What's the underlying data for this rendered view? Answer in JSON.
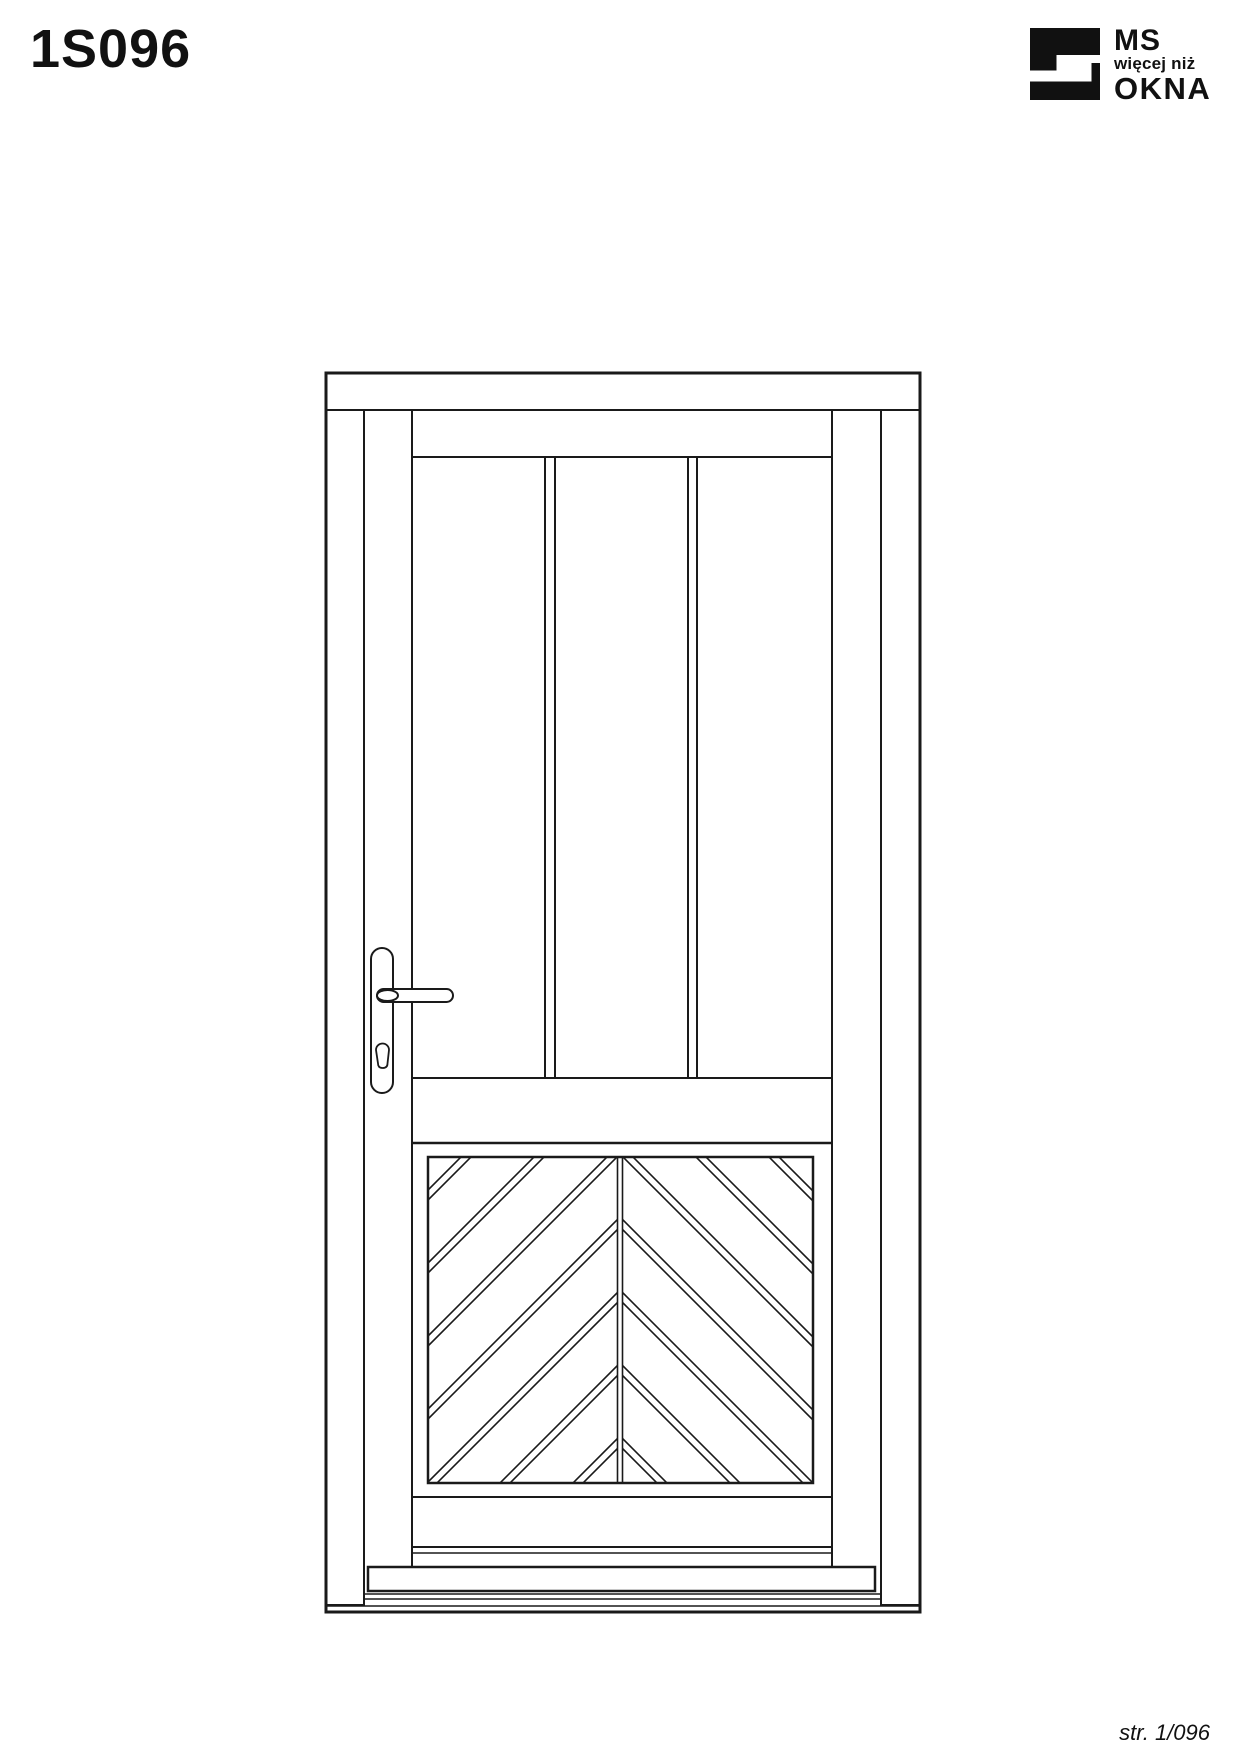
{
  "page": {
    "title": "1S096",
    "footer": "str. 1/096",
    "background": "#ffffff"
  },
  "logo": {
    "line1": "MS",
    "line2": "więcej niż",
    "line3": "OKNA",
    "color": "#111111"
  },
  "drawing": {
    "stroke_color": "#1a1a1a",
    "glass_color": "#b4b4b4",
    "panel_fill": "#ffffff",
    "chevron": {
      "c_start": 1618,
      "c_step": 73,
      "pair_offset": 10,
      "count": 7,
      "mirror_sum": 1240,
      "left": {
        "x0": 428,
        "x1": 618
      },
      "right": {
        "x0": 622,
        "x1": 813
      },
      "stroke_width": 1.6
    }
  }
}
